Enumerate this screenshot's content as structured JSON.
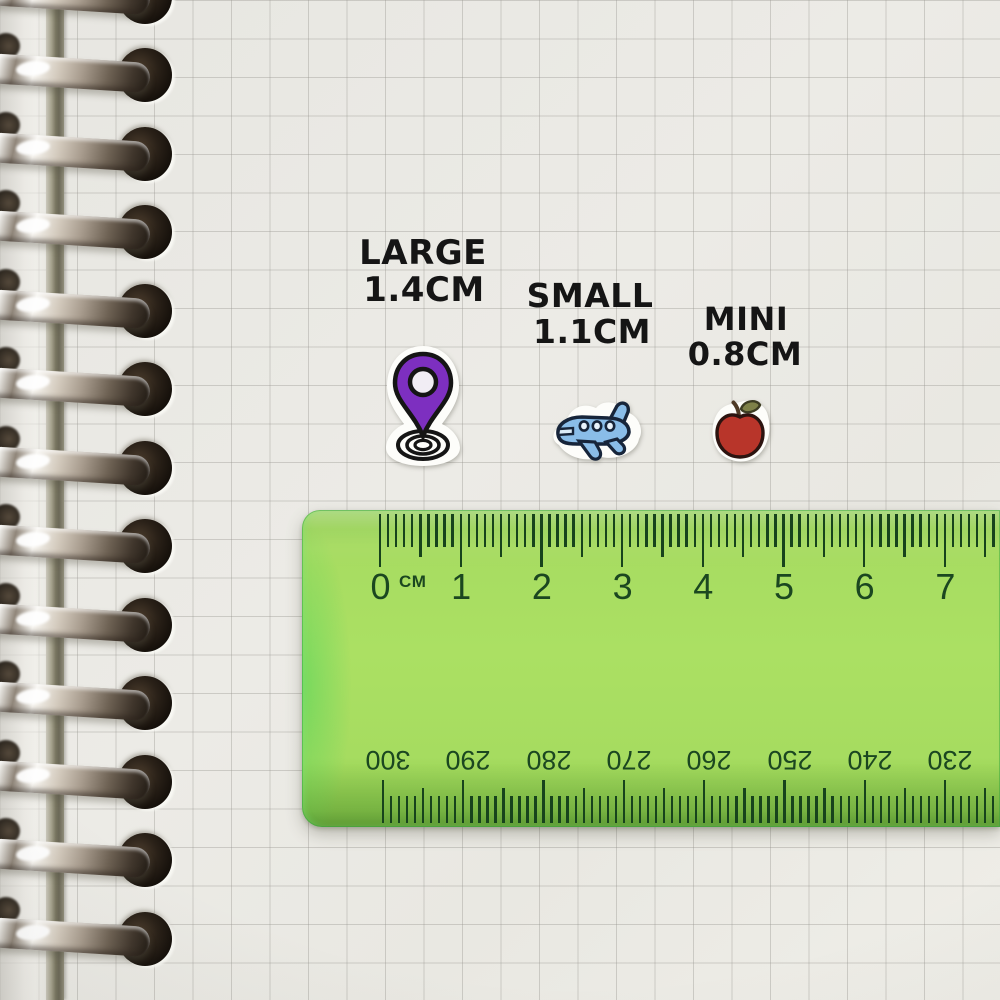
{
  "labels": {
    "large": {
      "line1": "LARGE",
      "line2": "1.4CM"
    },
    "small": {
      "line1": "SMALL",
      "line2": "1.1CM"
    },
    "mini": {
      "line1": "MINI",
      "line2": "0.8CM"
    }
  },
  "ruler": {
    "unit_label": "CM",
    "top_scale": [
      "0",
      "1",
      "2",
      "3",
      "4",
      "5",
      "6",
      "7"
    ],
    "bottom_scale": [
      "300",
      "290",
      "280",
      "270",
      "260",
      "250",
      "240",
      "230"
    ],
    "body_color": "#9ad54f",
    "mark_color": "#17431c"
  },
  "stickers": [
    {
      "name": "location-pin-sticker",
      "main_color": "#7d2fc0"
    },
    {
      "name": "airplane-sticker",
      "main_color": "#8abde8"
    },
    {
      "name": "apple-sticker",
      "main_color": "#b8352a"
    }
  ],
  "binding": {
    "ring_count": 13
  }
}
